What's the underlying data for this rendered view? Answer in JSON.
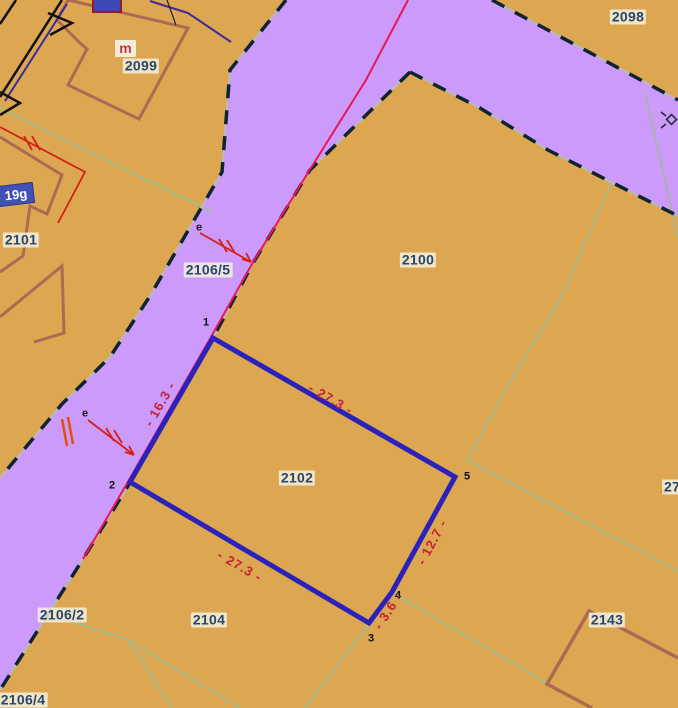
{
  "map": {
    "parcel_labels": [
      {
        "text": "2098"
      },
      {
        "text": "2099"
      },
      {
        "text": "2101"
      },
      {
        "text": "2100"
      },
      {
        "text": "2102"
      },
      {
        "text": "2104"
      },
      {
        "text": "2143"
      },
      {
        "text": "2106/5"
      },
      {
        "text": "2106/2"
      },
      {
        "text": "2106/4"
      },
      {
        "text": "27"
      }
    ],
    "annotations": {
      "house_number_badge": "19g",
      "building_use_mark": "m",
      "utility_mark_upper": "e",
      "utility_mark_lower": "e"
    },
    "highlighted_parcel": {
      "number": "2102",
      "vertices": [
        {
          "n": "1"
        },
        {
          "n": "2"
        },
        {
          "n": "3"
        },
        {
          "n": "4"
        },
        {
          "n": "5"
        }
      ],
      "edge_dimensions": [
        {
          "text": "- 16.3 -"
        },
        {
          "text": "- 27.3 -"
        },
        {
          "text": "- 12.7 -"
        },
        {
          "text": "- 3.6 -"
        },
        {
          "text": "- 27.3 -"
        }
      ]
    },
    "colors": {
      "parcel_fill": "#dda751",
      "road_fill": "#cb9afa",
      "road_edge_line": "#b7babd",
      "road_edge_dash": "#0f2430",
      "boundary_line": "#9cbd95",
      "highlight_outline": "#2b22bb",
      "road_axis_line": "#e8175a",
      "utility_red": "#d42015",
      "building_outline": "#ad6952",
      "dimension_text": "#c5203a",
      "parcel_label_text": "#27466b"
    }
  }
}
